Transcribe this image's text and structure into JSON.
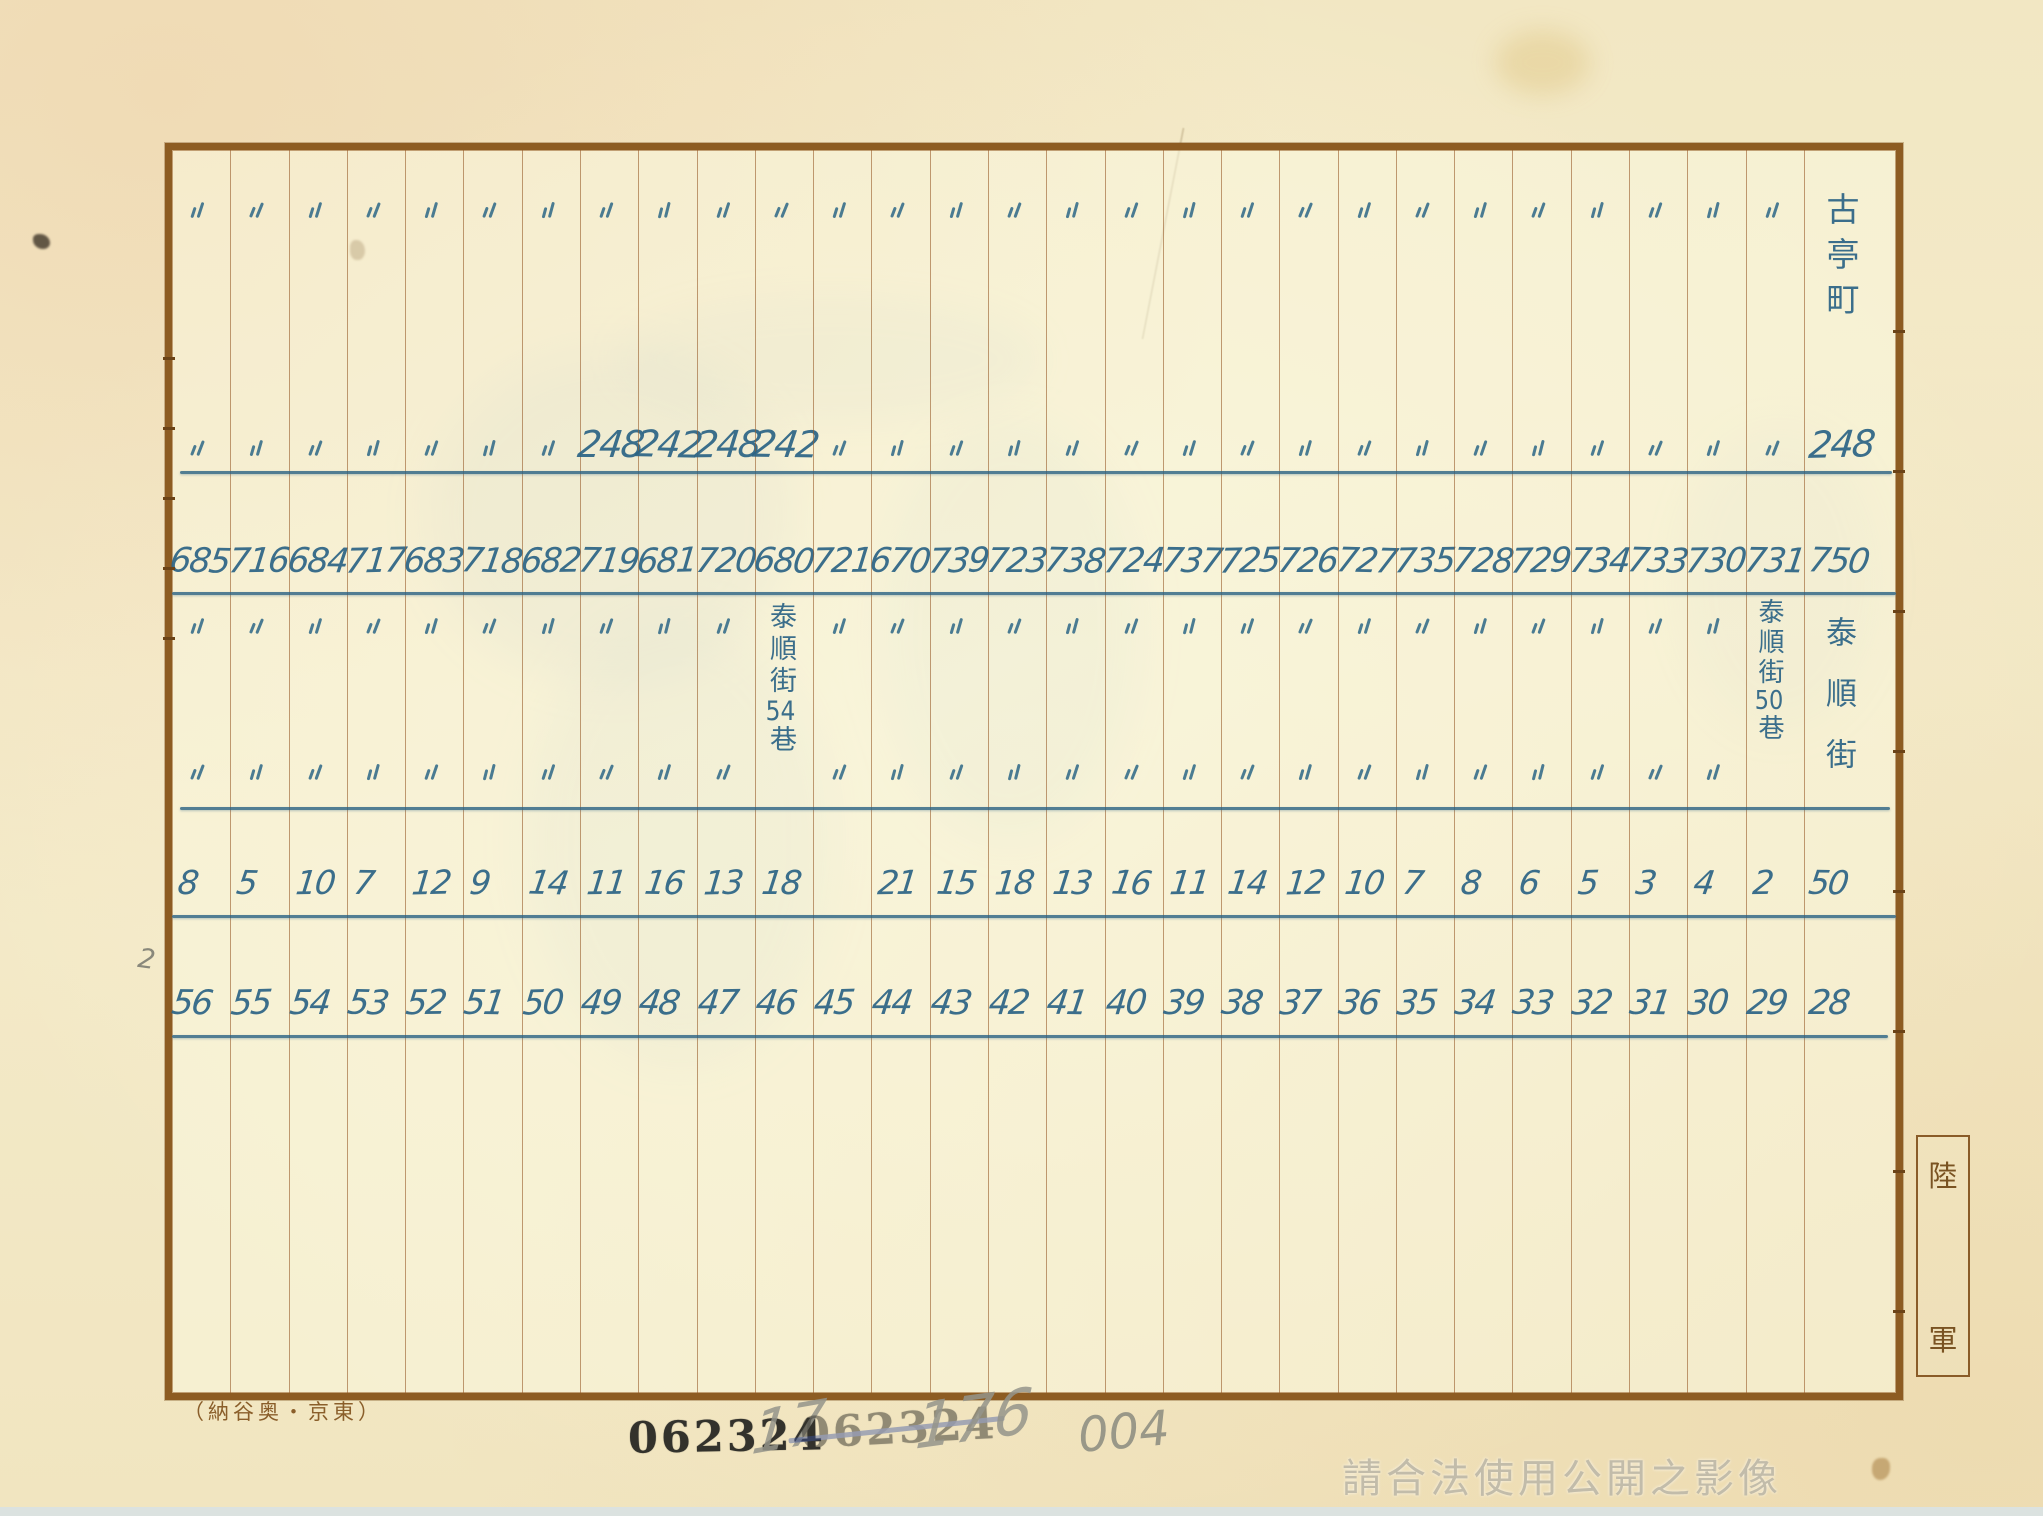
{
  "table": {
    "district_label": "古亭町",
    "ditto_mark": "〃",
    "ink_color": "#2e6a8d",
    "rule_color": "#8a5c26",
    "street_label_mid": {
      "prefix": "泰順街",
      "number": "54",
      "suffix": "巷"
    },
    "street_label_col28": {
      "prefix": "泰順街",
      "number": "50",
      "suffix": "巷"
    },
    "street_label_wide": "泰順街",
    "columns": [
      {
        "r1": "〃",
        "r2": "〃",
        "r3": "685",
        "r4": "〃",
        "r5": "〃",
        "r6": "8",
        "r7": "56"
      },
      {
        "r1": "〃",
        "r2": "〃",
        "r3": "716",
        "r4": "〃",
        "r5": "〃",
        "r6": "5",
        "r7": "55"
      },
      {
        "r1": "〃",
        "r2": "〃",
        "r3": "684",
        "r4": "〃",
        "r5": "〃",
        "r6": "10",
        "r7": "54"
      },
      {
        "r1": "〃",
        "r2": "〃",
        "r3": "717",
        "r4": "〃",
        "r5": "〃",
        "r6": "7",
        "r7": "53"
      },
      {
        "r1": "〃",
        "r2": "〃",
        "r3": "683",
        "r4": "〃",
        "r5": "〃",
        "r6": "12",
        "r7": "52"
      },
      {
        "r1": "〃",
        "r2": "〃",
        "r3": "718",
        "r4": "〃",
        "r5": "〃",
        "r6": "9",
        "r7": "51"
      },
      {
        "r1": "〃",
        "r2": "〃",
        "r3": "682",
        "r4": "〃",
        "r5": "〃",
        "r6": "14",
        "r7": "50"
      },
      {
        "r1": "〃",
        "r2": "248",
        "r3": "719",
        "r4": "〃",
        "r5": "〃",
        "r6": "11",
        "r7": "49"
      },
      {
        "r1": "〃",
        "r2": "242",
        "r3": "681",
        "r4": "〃",
        "r5": "〃",
        "r6": "16",
        "r7": "48"
      },
      {
        "r1": "〃",
        "r2": "248",
        "r3": "720",
        "r4": "〃",
        "r5": "〃",
        "r6": "13",
        "r7": "47"
      },
      {
        "r1": "〃",
        "r2": "242",
        "r3": "680",
        "r4": "",
        "r5": "",
        "r6": "18",
        "r7": "46"
      },
      {
        "r1": "〃",
        "r2": "〃",
        "r3": "721",
        "r4": "〃",
        "r5": "〃",
        "r6": "",
        "r7": "45"
      },
      {
        "r1": "〃",
        "r2": "〃",
        "r3": "670",
        "r4": "〃",
        "r5": "〃",
        "r6": "21",
        "r7": "44"
      },
      {
        "r1": "〃",
        "r2": "〃",
        "r3": "739",
        "r4": "〃",
        "r5": "〃",
        "r6": "15",
        "r7": "43"
      },
      {
        "r1": "〃",
        "r2": "〃",
        "r3": "723",
        "r4": "〃",
        "r5": "〃",
        "r6": "18",
        "r7": "42"
      },
      {
        "r1": "〃",
        "r2": "〃",
        "r3": "738",
        "r4": "〃",
        "r5": "〃",
        "r6": "13",
        "r7": "41"
      },
      {
        "r1": "〃",
        "r2": "〃",
        "r3": "724",
        "r4": "〃",
        "r5": "〃",
        "r6": "16",
        "r7": "40"
      },
      {
        "r1": "〃",
        "r2": "〃",
        "r3": "737",
        "r4": "〃",
        "r5": "〃",
        "r6": "11",
        "r7": "39"
      },
      {
        "r1": "〃",
        "r2": "〃",
        "r3": "725",
        "r4": "〃",
        "r5": "〃",
        "r6": "14",
        "r7": "38"
      },
      {
        "r1": "〃",
        "r2": "〃",
        "r3": "726",
        "r4": "〃",
        "r5": "〃",
        "r6": "12",
        "r7": "37"
      },
      {
        "r1": "〃",
        "r2": "〃",
        "r3": "727",
        "r4": "〃",
        "r5": "〃",
        "r6": "10",
        "r7": "36"
      },
      {
        "r1": "〃",
        "r2": "〃",
        "r3": "735",
        "r4": "〃",
        "r5": "〃",
        "r6": "7",
        "r7": "35"
      },
      {
        "r1": "〃",
        "r2": "〃",
        "r3": "728",
        "r4": "〃",
        "r5": "〃",
        "r6": "8",
        "r7": "34"
      },
      {
        "r1": "〃",
        "r2": "〃",
        "r3": "729",
        "r4": "〃",
        "r5": "〃",
        "r6": "6",
        "r7": "33"
      },
      {
        "r1": "〃",
        "r2": "〃",
        "r3": "734",
        "r4": "〃",
        "r5": "〃",
        "r6": "5",
        "r7": "32"
      },
      {
        "r1": "〃",
        "r2": "〃",
        "r3": "733",
        "r4": "〃",
        "r5": "〃",
        "r6": "3",
        "r7": "31"
      },
      {
        "r1": "〃",
        "r2": "〃",
        "r3": "730",
        "r4": "〃",
        "r5": "〃",
        "r6": "4",
        "r7": "30"
      },
      {
        "r1": "〃",
        "r2": "〃",
        "r3": "731",
        "r4": "",
        "r5": "",
        "r6": "2",
        "r7": "29"
      }
    ],
    "wide_column": {
      "r2": "248",
      "r3": "750",
      "r6": "50",
      "r7": "28"
    }
  },
  "margins": {
    "publisher_imprint": "（納谷奥・京東）",
    "army_label": [
      "陸",
      "軍"
    ],
    "page_pencil_mark": "2",
    "archive_stamp": "062324",
    "archive_stamp_cancelled": "062324",
    "pencil_marks": [
      "17",
      "176",
      "004"
    ],
    "watermark": "請合法使用公開之影像"
  }
}
